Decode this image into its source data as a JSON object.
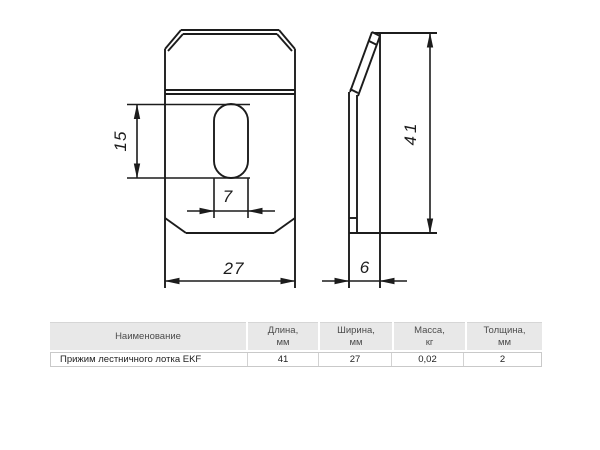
{
  "drawing": {
    "front_view": {
      "width_label": "27",
      "slot_length_label": "15",
      "slot_width_label": "7"
    },
    "side_view": {
      "height_label": "41",
      "depth_label": "6"
    }
  },
  "table": {
    "headers": [
      {
        "title": "Наименование",
        "unit": ""
      },
      {
        "title": "Длина,",
        "unit": "мм"
      },
      {
        "title": "Ширина,",
        "unit": "мм"
      },
      {
        "title": "Масса,",
        "unit": "кг"
      },
      {
        "title": "Толщина,",
        "unit": "мм"
      }
    ],
    "rows": [
      {
        "name": "Прижим лестничного лотка EKF",
        "length_mm": "41",
        "width_mm": "27",
        "mass_kg": "0,02",
        "thickness_mm": "2"
      }
    ]
  },
  "colors": {
    "line": "#1c1c1c",
    "table_header_bg": "#e8e8e8",
    "table_header_text": "#4c4c4c",
    "table_border": "#c9c9c9",
    "background": "#ffffff"
  }
}
